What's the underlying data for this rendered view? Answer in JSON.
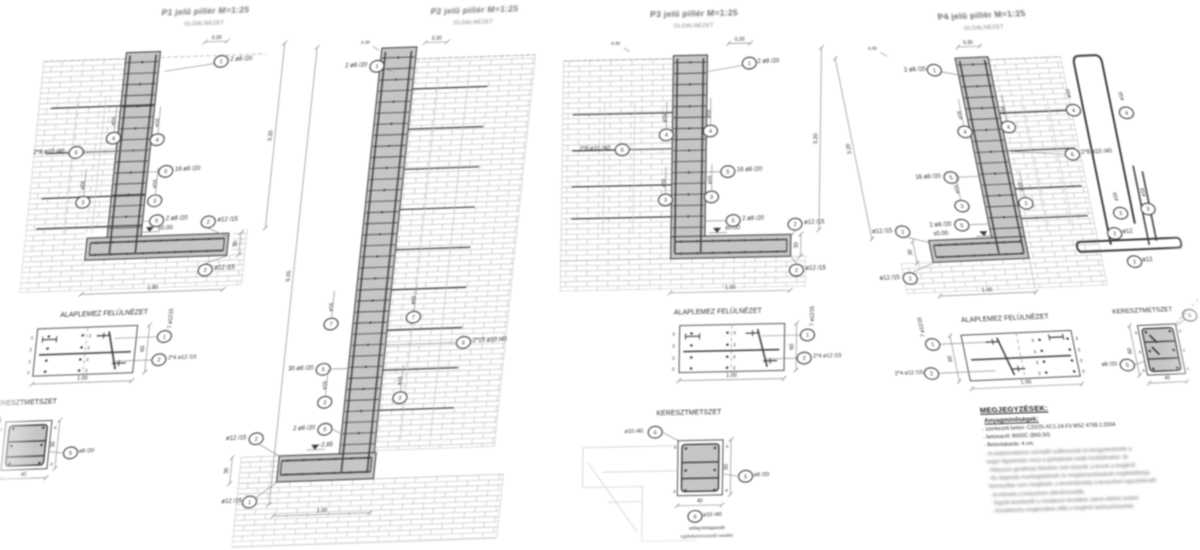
{
  "colors": {
    "line": "#3a3a3a",
    "concrete": "#c6c6c6",
    "concrete_dark": "#b2b2b2",
    "masonry": "#bcbcbc",
    "dim": "#8c8c8c",
    "text": "#2f2f2f",
    "paper": "#ffffff"
  },
  "panels": [
    {
      "id": "P1",
      "title": "P1 jelű pillér M=1:25",
      "subtitle": "OLDALNÉZET",
      "side": {
        "top_dim": "0.30",
        "top_bar": "2 ø8 /20",
        "top_bar_pos": "1",
        "mesh": "2*8 ø10 /40",
        "mesh_pos": "6",
        "bar_upper": "ø16",
        "bar_upper_pos": "4",
        "bar_lower": "ø16",
        "bar_lower_pos": "3",
        "stirrups": "16 ø8 /20",
        "stirrups_pos": "5",
        "foot_stirrups": "2 ø8 /20",
        "foot_stirrups_pos": "5",
        "level": "±0.00",
        "foot_top": "ø12 /15",
        "foot_top_pos": "2",
        "foot_bottom": "ø12 /15",
        "foot_bottom_pos": "2",
        "width": "1.00",
        "height": "3.20",
        "foot_height": "30"
      },
      "plan": {
        "title": "ALAPLEMEZ FELÜLNÉZET",
        "long_bars": "7 ø12/15",
        "long_bars_pos": "1",
        "cross_bars": "2*4 ø12 /15",
        "cross_bars_pos": "2",
        "width": "1.00",
        "depth": "60",
        "spacing_mark": "3"
      },
      "section": {
        "title": "KERESZTMETSZET",
        "stirrup": "ø8 /20",
        "stirrup_pos": "5",
        "width": "40",
        "height": "30",
        "cover_mark": "4",
        "corner_pos": "6"
      }
    },
    {
      "id": "P2",
      "title": "P2 jelű pillér M=1:25",
      "subtitle": "OLDALNÉZET",
      "side": {
        "top_dim": "0.30",
        "top_bar": "2 ø8 /20",
        "top_bar_pos": "1",
        "mesh": "2*15 ø10 /40",
        "mesh_pos": "6",
        "bar_upper": "ø16",
        "bar_upper_pos": "7",
        "bar_lower": "ø16",
        "bar_lower_pos": "3",
        "stirrups": "30 ø8 /20",
        "stirrups_pos": "5",
        "foot_stirrups": "2 ø8 /20",
        "foot_stirrups_pos": "5",
        "level": "-2.85",
        "foot_top": "ø12 /15",
        "foot_top_pos": "2",
        "foot_bottom": "ø12 /15",
        "foot_bottom_pos": "1",
        "width": "1.00",
        "height": "6.05",
        "foot_height": "30"
      }
    },
    {
      "id": "P3",
      "title": "P3 jelű pillér M=1:25",
      "subtitle": "OLDALNÉZET",
      "side": {
        "top_dim": "0.30",
        "top_bar": "2 ø8 /20",
        "top_bar_pos": "1",
        "mesh": "2*8 ø10 /40",
        "mesh_pos": "6",
        "bar_upper": "ø16",
        "bar_upper_pos": "4",
        "bar_lower": "ø16",
        "bar_lower_pos": "3",
        "stirrups": "16 ø8 /20",
        "stirrups_pos": "5",
        "foot_stirrups": "2 ø8 /20",
        "foot_stirrups_pos": "5",
        "level": "±0.00",
        "foot_top": "ø12 /15",
        "foot_top_pos": "2",
        "foot_bottom": "ø12 /15",
        "foot_bottom_pos": "2",
        "width": "1.00",
        "height": "3.20",
        "foot_height": "30"
      },
      "plan": {
        "title": "ALAPLEMEZ FELÜLNÉZET",
        "long_bars": "7 ø12/15",
        "long_bars_pos": "1",
        "cross_bars": "2*4 ø12 /15",
        "cross_bars_pos": "2",
        "width": "1.00",
        "depth": "60",
        "spacing_mark": "3"
      },
      "section": {
        "title": "KERESZTMETSZET",
        "stirrup": "ø8 /20",
        "stirrup_pos": "5",
        "tie": "ø10 /40",
        "tie_pos": "6",
        "width": "40",
        "height": "30",
        "cover_mark": "4",
        "caption1": "utólag kimagasodó",
        "caption2": "egybebetonozandó vasalás"
      }
    },
    {
      "id": "P4",
      "title": "P4 jelű pillér M=1:25",
      "subtitle": "OLDALNÉZET",
      "side": {
        "top_dim": "0.30",
        "top_bar": "2 ø8 /20",
        "top_bar_pos": "1",
        "mesh": "2*8 ø10 /40",
        "mesh_pos": "6",
        "bar_upper": "ø16",
        "bar_upper_pos": "4",
        "bar_lower": "ø16",
        "bar_lower_pos": "3",
        "stirrups": "16 ø8 /20",
        "stirrups_pos": "5",
        "foot_stirrups": "2 ø8 /20",
        "foot_stirrups_pos": "5",
        "level": "±0.00",
        "foot_top": "ø12 /15",
        "foot_top_pos": "2",
        "foot_bottom": "ø12 /15",
        "foot_bottom_pos": "2",
        "width": "1.00",
        "height": "3.20",
        "foot_height": "30"
      },
      "plan": {
        "title": "ALAPLEMEZ FELÜLNÉZET",
        "long_bars": "7 ø12/15",
        "long_bars_pos": "1",
        "cross_bars": "2*4 ø12 /15",
        "cross_bars_pos": "2",
        "width": "1.00",
        "depth": "60",
        "spacing_mark": "3"
      },
      "section": {
        "title": "KERESZTMETSZET",
        "stirrup": "ø8 /20",
        "stirrup_pos": "5",
        "width": "40",
        "height": "60",
        "cover_mark": "4",
        "corner_pos": "6"
      },
      "shapes": {
        "bar_u": "ø16",
        "bar_u_pos": "4",
        "bar_l": "ø16",
        "bar_l_pos": "3",
        "bar_f1": "ø12",
        "bar_f1_pos": "2",
        "bar_f2": "ø12",
        "bar_f2_pos": "2"
      }
    }
  ],
  "notes": {
    "title": "MEGJEGYZÉSEK:",
    "materials_heading": "Anyagminőségek:",
    "lines": [
      "- szerkezeti beton: C20/25-XC1-24-F3 MSZ 4798-1:2004",
      "- betonacél: B500C (B60.50)",
      "- Betontakarás: 4 cm.",
      "- A vaskivonatokon szereplő szálhosszak és kengyelméretek a",
      "   vegye figyelembe veszi a görbülések miatti rövidüléseket. (A",
      "- Helyszíni geodéziai felmérés nem készült, a tervek a meglévő",
      "- Az alapozás munkagödrének és megtámasztásának megfelelősége",
      "   bizonyultan nem megfelelő, a tervmódosítás a tervezővel egyeztetendő",
      "- A méretek a helyszínen ellenőrizendők.",
      "- Együtt kezelendő a vonatkozó tervekkel, bármi eltérés esetén",
      "- A kivitelezés megkezdése előtt a meglévő tartószerkezetek"
    ]
  }
}
